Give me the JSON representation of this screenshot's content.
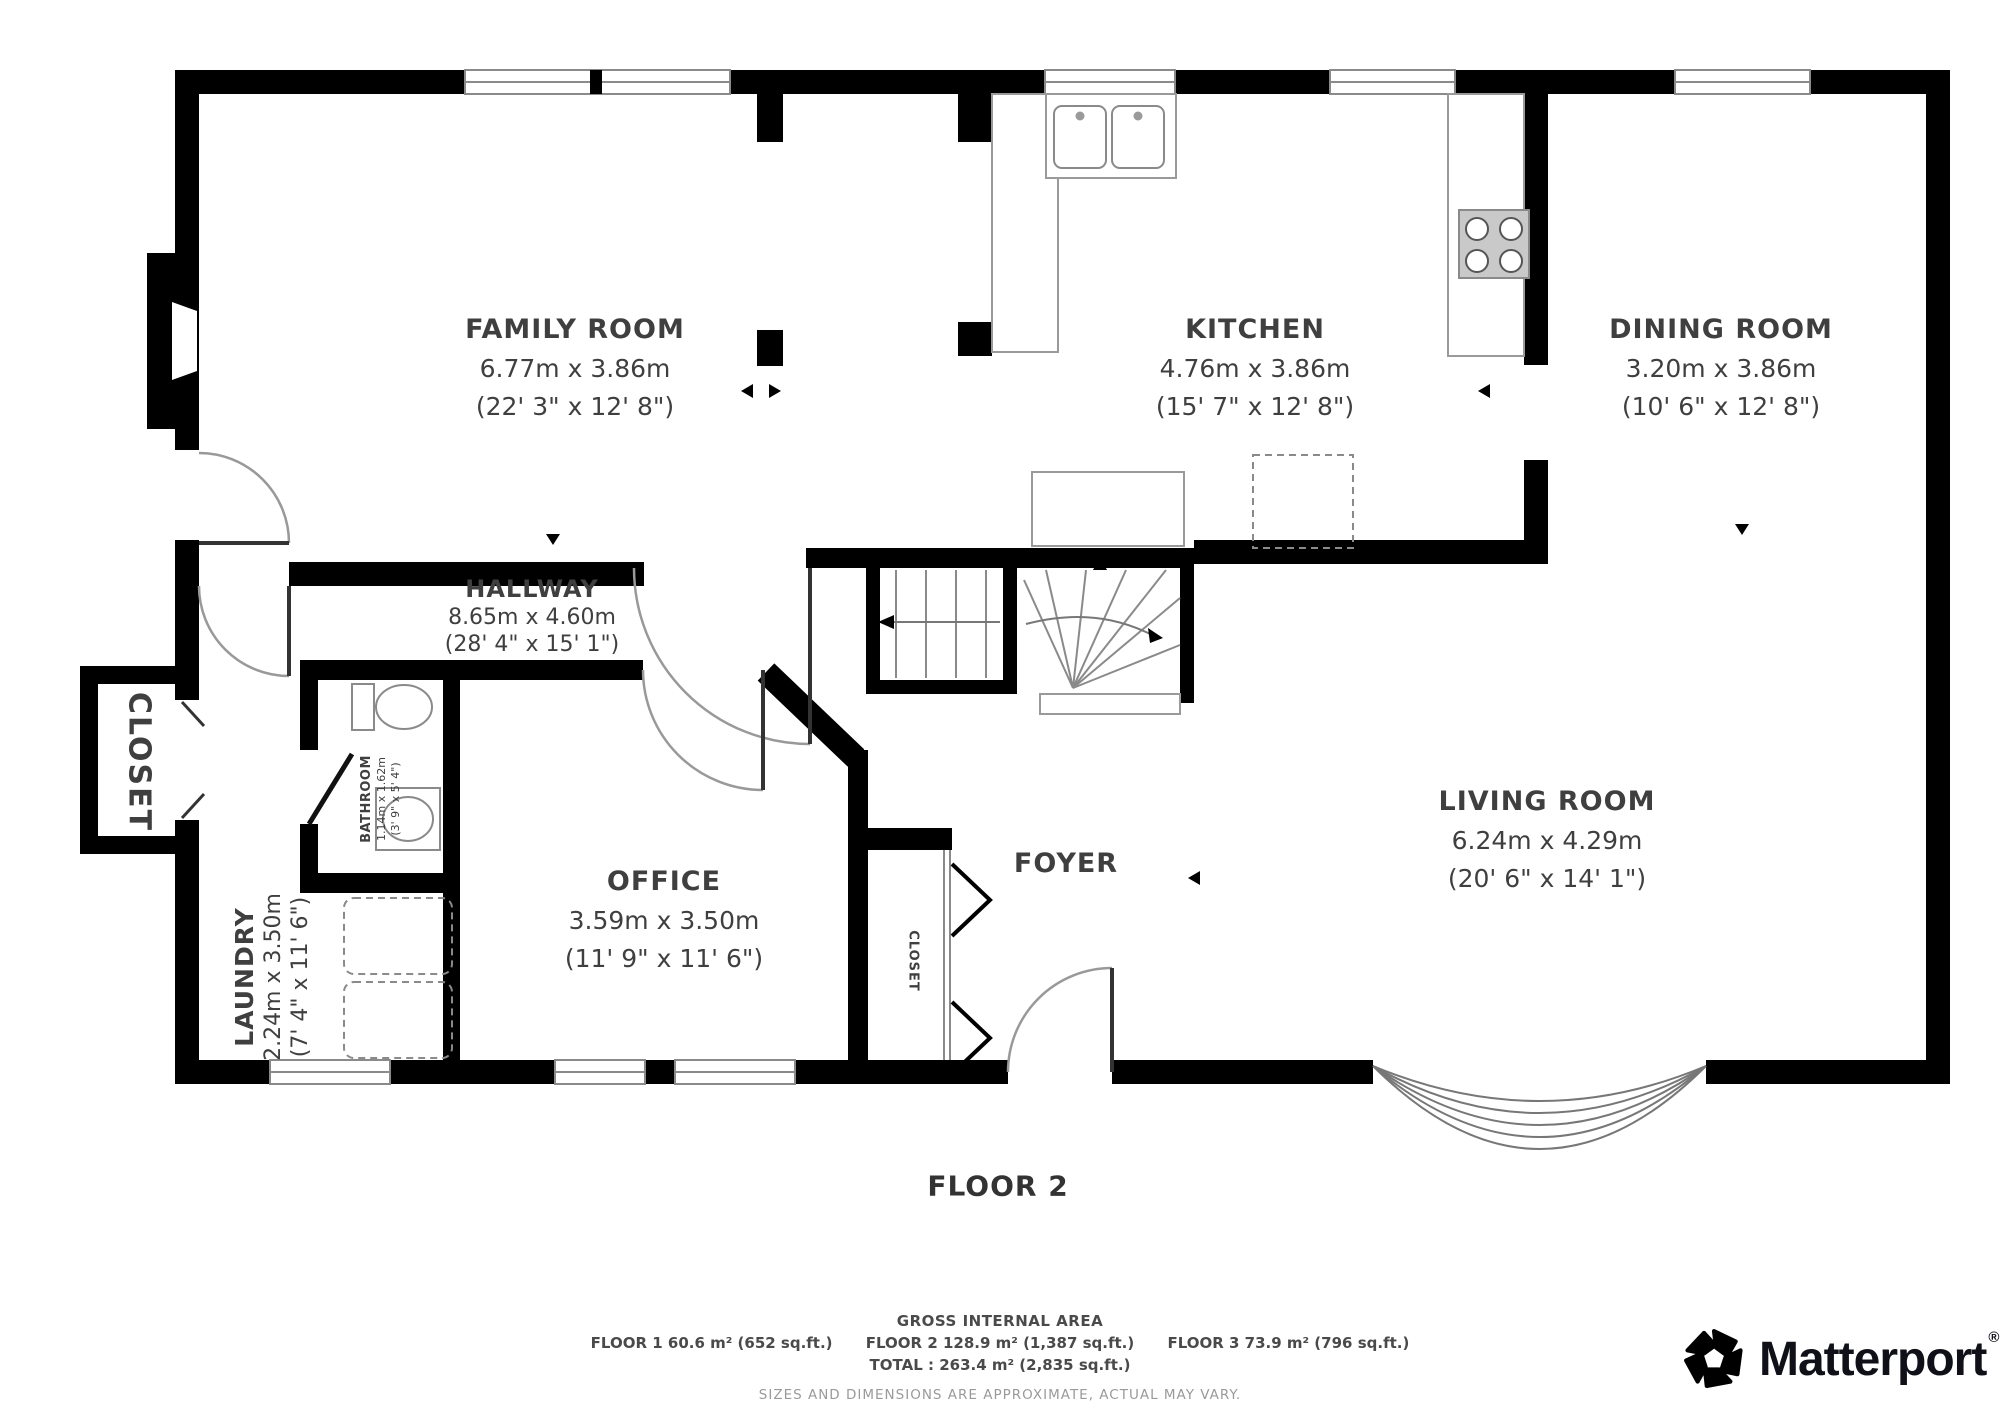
{
  "plan": {
    "floor_label": "FLOOR 2",
    "rooms": {
      "family": {
        "name": "FAMILY ROOM",
        "metric": "6.77m x 3.86m",
        "imperial": "(22' 3\" x 12' 8\")"
      },
      "kitchen": {
        "name": "KITCHEN",
        "metric": "4.76m x 3.86m",
        "imperial": "(15' 7\" x 12' 8\")"
      },
      "dining": {
        "name": "DINING ROOM",
        "metric": "3.20m x 3.86m",
        "imperial": "(10' 6\" x 12' 8\")"
      },
      "hallway": {
        "name": "HALLWAY",
        "metric": "8.65m x 4.60m",
        "imperial": "(28' 4\" x 15' 1\")"
      },
      "office": {
        "name": "OFFICE",
        "metric": "3.59m x 3.50m",
        "imperial": "(11' 9\" x 11' 6\")"
      },
      "living": {
        "name": "LIVING ROOM",
        "metric": "6.24m x 4.29m",
        "imperial": "(20' 6\" x 14' 1\")"
      },
      "bathroom": {
        "name": "BATHROOM",
        "metric": "1.14m x 1.62m",
        "imperial": "(3' 9\" x 5' 4\")"
      },
      "laundry": {
        "name": "LAUNDRY",
        "metric": "2.24m x 3.50m",
        "imperial": "(7' 4\" x 11' 6\")"
      },
      "foyer": {
        "name": "FOYER"
      },
      "closet_hall": {
        "name": "CLOSET"
      },
      "closet_foyer": {
        "name": "CLOSET"
      }
    }
  },
  "footer": {
    "gross_title": "GROSS INTERNAL AREA",
    "floors": [
      "FLOOR 1 60.6 m² (652 sq.ft.)",
      "FLOOR 2 128.9 m² (1,387 sq.ft.)",
      "FLOOR 3 73.9 m² (796 sq.ft.)"
    ],
    "total": "TOTAL :  263.4 m² (2,835 sq.ft.)",
    "disclaimer": "SIZES AND DIMENSIONS ARE APPROXIMATE, ACTUAL MAY VARY."
  },
  "branding": {
    "name": "Matterport",
    "registered": "®"
  },
  "colors": {
    "wall": "#000000",
    "thin_line": "#8a8a8a",
    "label": "#3f3f3f",
    "disclaimer": "#9a9a9a"
  }
}
